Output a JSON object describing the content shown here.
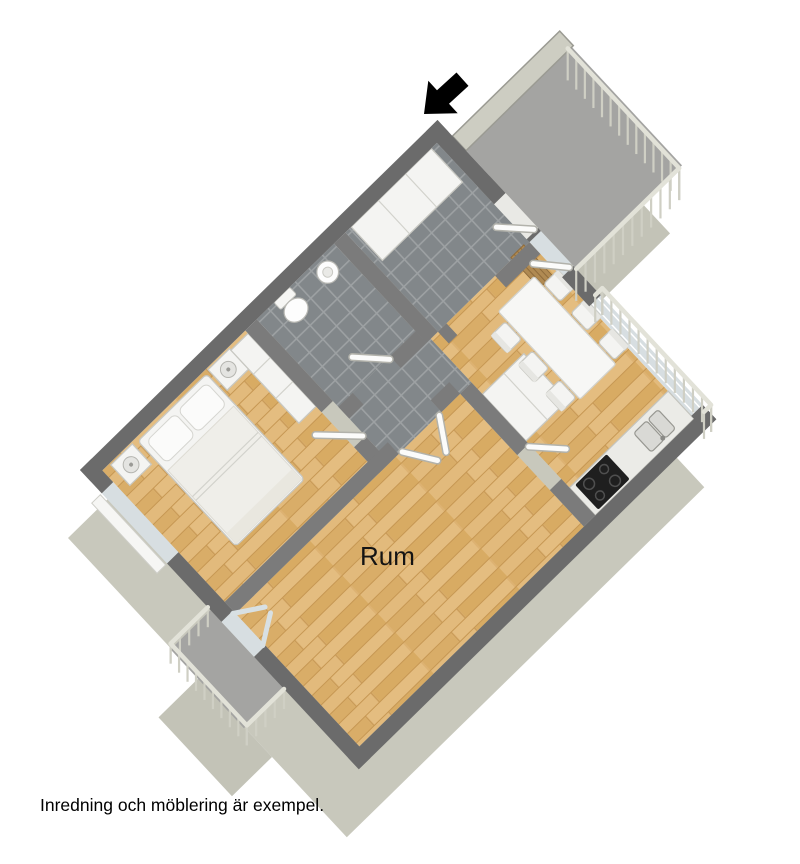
{
  "floorplan": {
    "room_label": "Rum",
    "disclaimer": "Inredning och möblering är exempel."
  },
  "icons": {
    "entrance_arrow": "entrance-direction-arrow"
  },
  "colors": {
    "background": "#ffffff",
    "wall_top": "#6b6b6b",
    "inner_wall": "#7b7b7b",
    "facade": "#c8c8bc",
    "wood_floor": "#ddb272",
    "tile_floor": "#82878a",
    "balcony_floor": "#a4a4a2",
    "railing": "#e2e2d8",
    "railing_dark": "#cfcfc4",
    "arrow": "#000000",
    "label_text": "#141414"
  }
}
